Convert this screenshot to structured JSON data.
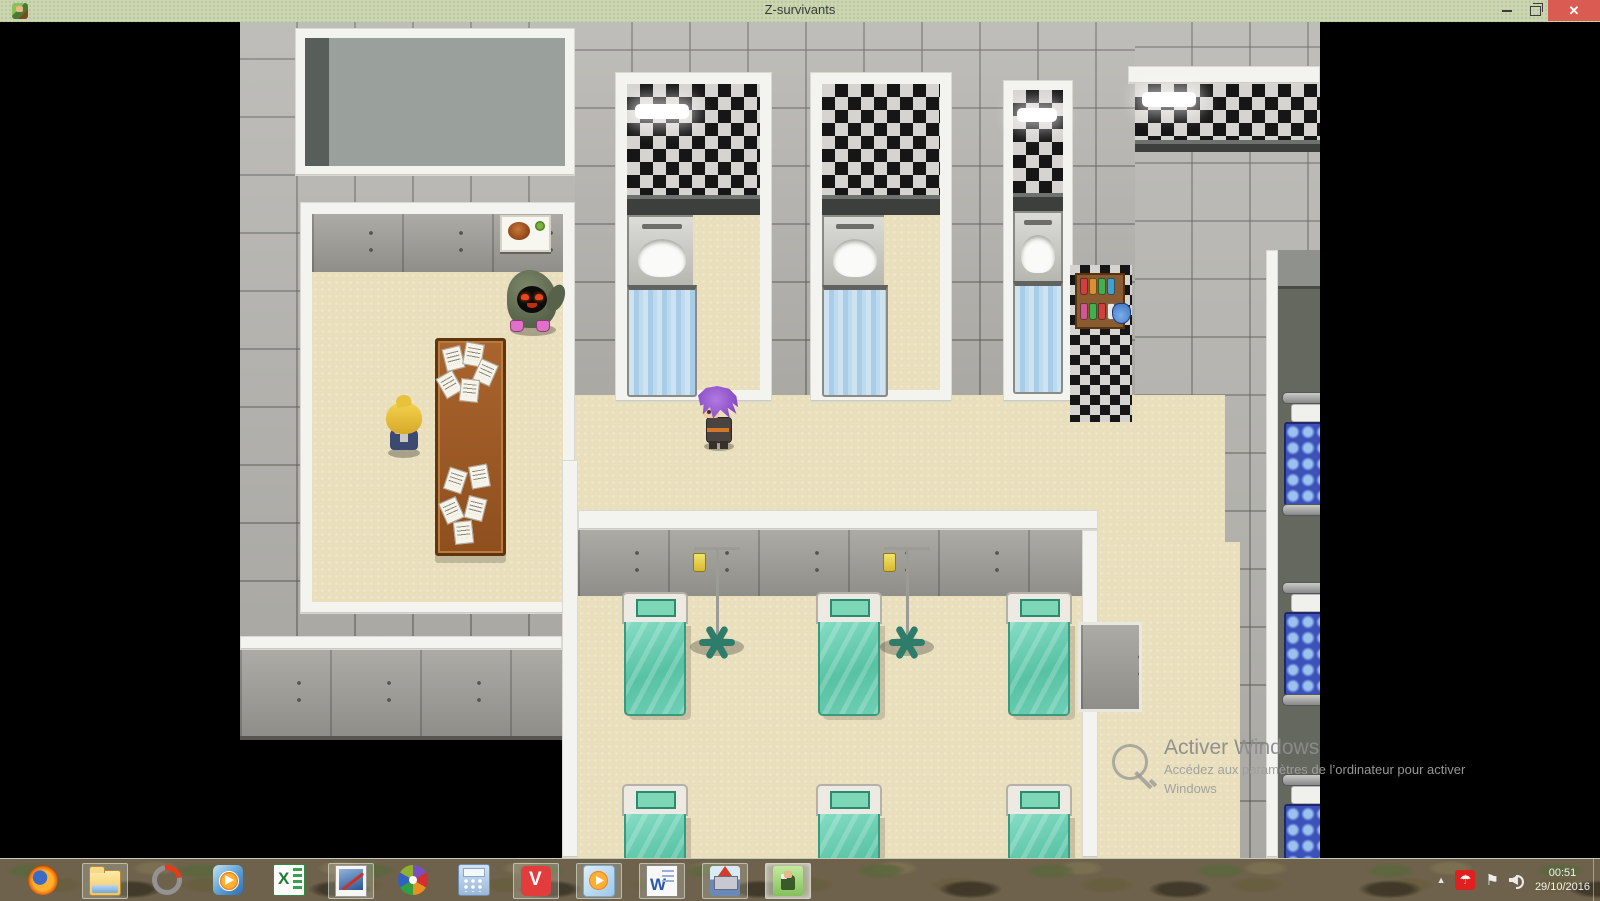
{
  "window": {
    "title": "Z-survivants"
  },
  "controls": {
    "close_glyph": "✕"
  },
  "game": {
    "map_name": "hospital-interior",
    "entities": [
      "hooded-ghoul-enemy",
      "blonde-npc",
      "player-purple-hair",
      "paper-covered-desk",
      "food-wall-picture",
      "shower-stall",
      "washbasin",
      "shower-curtain",
      "hospital-bed-teal",
      "iv-drip-stand",
      "potion-shelf",
      "bunk-bed-blue",
      "checkered-wall",
      "metal-wall"
    ],
    "colors": {
      "floor_beige": "#e9dfbc",
      "tile_grey": "#b4b3ae",
      "wall_white": "#f3f3ef",
      "checker_dark": "#161616",
      "checker_light": "#d6d4d0",
      "bed_teal": "#5fc9ae",
      "bed_blue": "#3c52b8",
      "curtain_blue": "#bedaee",
      "desk_wood": "#9c5a28"
    }
  },
  "watermark": {
    "title": "Activer Windows",
    "line1": "Accédez aux paramètres de l’ordinateur pour activer",
    "line2": "Windows"
  },
  "taskbar": {
    "items": [
      {
        "name": "firefox",
        "open": false,
        "active": false
      },
      {
        "name": "file-explorer",
        "open": true,
        "active": false
      },
      {
        "name": "ring-utility",
        "open": false,
        "active": false
      },
      {
        "name": "wmp",
        "open": false,
        "active": false
      },
      {
        "name": "excel",
        "open": false,
        "active": false
      },
      {
        "name": "paint-editor",
        "open": true,
        "active": false
      },
      {
        "name": "picasa",
        "open": false,
        "active": false
      },
      {
        "name": "calculator",
        "open": false,
        "active": false
      },
      {
        "name": "vivaldi",
        "open": true,
        "active": false
      },
      {
        "name": "media-player",
        "open": true,
        "active": false
      },
      {
        "name": "word",
        "open": true,
        "active": false
      },
      {
        "name": "castle-game",
        "open": true,
        "active": false
      },
      {
        "name": "z-survivants",
        "open": true,
        "active": true
      }
    ],
    "tray": {
      "show_hidden_glyph": "▲",
      "flag_glyph": "⚑",
      "avira_glyph": "☂",
      "time": "00:51",
      "date": "29/10/2016"
    }
  }
}
